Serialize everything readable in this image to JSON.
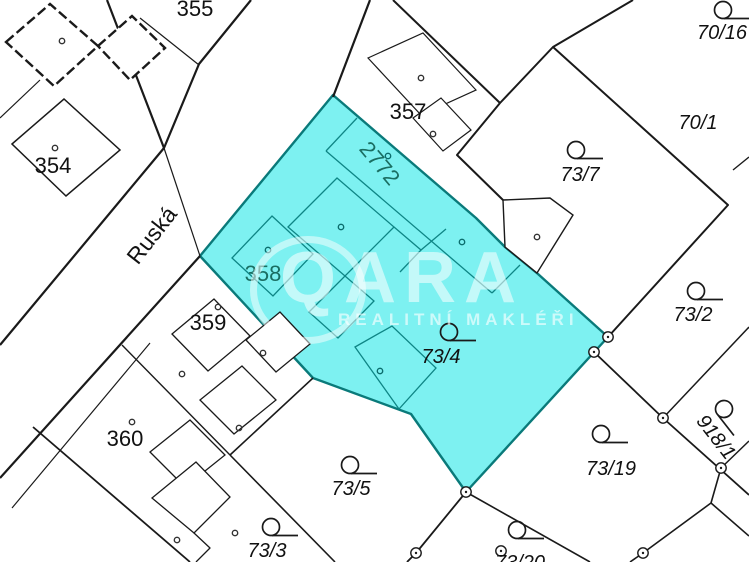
{
  "meta": {
    "width": 749,
    "height": 562
  },
  "watermark": {
    "brand": "QARA",
    "reg": "®",
    "tagline": "REALITNÍ MAKLÉŘI"
  },
  "map": {
    "colors": {
      "background": "#ffffff",
      "line": "#1a1a1a",
      "highlight_fill": "#7DF1F1",
      "highlight_stroke": "#0A7A7A",
      "teal_line": "#0E8585",
      "teal_text": "#1A6E62",
      "label": "#111111"
    },
    "highlight": {
      "outer": [
        [
          333,
          95
        ],
        [
          476,
          218
        ],
        [
          488,
          230
        ],
        [
          505,
          247
        ],
        [
          538,
          274
        ],
        [
          608,
          337
        ],
        [
          466,
          492
        ],
        [
          411,
          414
        ],
        [
          313,
          378
        ],
        [
          200,
          256
        ]
      ],
      "inner_closed": [
        {
          "pts": [
            [
              337,
              178
            ],
            [
              394,
              227
            ],
            [
              345,
              276
            ],
            [
              288,
              227
            ]
          ]
        },
        {
          "pts": [
            [
              272,
              216
            ],
            [
              313,
              254
            ],
            [
              273,
              296
            ],
            [
              232,
              258
            ]
          ]
        },
        {
          "pts": [
            [
              345,
              276
            ],
            [
              374,
              301
            ],
            [
              338,
              338
            ],
            [
              309,
              312
            ]
          ]
        },
        {
          "pts": [
            [
              355,
              347
            ],
            [
              392,
              326
            ],
            [
              436,
              368
            ],
            [
              399,
              409
            ]
          ]
        }
      ],
      "inner_open": [
        {
          "pts": [
            [
              357,
              118
            ],
            [
              326,
              151
            ]
          ]
        },
        {
          "pts": [
            [
              326,
              151
            ],
            [
              492,
              293
            ]
          ]
        },
        {
          "pts": [
            [
              492,
              293
            ],
            [
              520,
              265
            ]
          ]
        },
        {
          "pts": [
            [
              394,
              227
            ],
            [
              421,
              250
            ],
            [
              446,
              229
            ]
          ]
        },
        {
          "pts": [
            [
              421,
              250
            ],
            [
              400,
              272
            ]
          ]
        }
      ],
      "dots": [
        [
          341,
          227
        ],
        [
          268,
          250
        ],
        [
          388,
          156
        ],
        [
          462,
          242
        ],
        [
          380,
          371
        ]
      ]
    },
    "lines": [
      {
        "pts": [
          [
            107,
            0
          ],
          [
            164,
            148
          ]
        ],
        "w": 2.2
      },
      {
        "pts": [
          [
            251,
            0
          ],
          [
            199,
            64
          ],
          [
            164,
            148
          ],
          [
            0,
            345
          ]
        ],
        "w": 2.2
      },
      {
        "pts": [
          [
            370,
            0
          ],
          [
            333,
            97
          ]
        ],
        "w": 2.2
      },
      {
        "pts": [
          [
            200,
            256
          ],
          [
            0,
            478
          ]
        ],
        "w": 2.2
      },
      {
        "pts": [
          [
            140,
            18
          ],
          [
            199,
            65
          ]
        ],
        "w": 1.2
      },
      {
        "pts": [
          [
            0,
            118
          ],
          [
            40,
            80
          ]
        ],
        "w": 1.2
      },
      {
        "pts": [
          [
            164,
            148
          ],
          [
            200,
            256
          ]
        ],
        "w": 1.2
      },
      {
        "pts": [
          [
            393,
            0
          ],
          [
            500,
            103
          ]
        ],
        "w": 2
      },
      {
        "pts": [
          [
            633,
            0
          ],
          [
            553,
            47
          ],
          [
            500,
            103
          ],
          [
            457,
            155
          ],
          [
            503,
            200
          ]
        ],
        "w": 2
      },
      {
        "pts": [
          [
            553,
            47
          ],
          [
            728,
            205
          ],
          [
            608,
            337
          ]
        ],
        "w": 2
      },
      {
        "pts": [
          [
            594,
            352
          ],
          [
            663,
            418
          ],
          [
            749,
            495
          ]
        ],
        "w": 1.8
      },
      {
        "pts": [
          [
            663,
            418
          ],
          [
            749,
            327
          ]
        ],
        "w": 1.5
      },
      {
        "pts": [
          [
            721,
            468
          ],
          [
            749,
            441
          ]
        ],
        "w": 1.5
      },
      {
        "pts": [
          [
            721,
            468
          ],
          [
            711,
            503
          ],
          [
            643,
            553
          ],
          [
            630,
            562
          ]
        ],
        "w": 1.6
      },
      {
        "pts": [
          [
            711,
            503
          ],
          [
            749,
            536
          ]
        ],
        "w": 1.6
      },
      {
        "pts": [
          [
            466,
            492
          ],
          [
            416,
            553
          ],
          [
            407,
            562
          ]
        ],
        "w": 1.8
      },
      {
        "pts": [
          [
            466,
            492
          ],
          [
            590,
            562
          ]
        ],
        "w": 1.6
      },
      {
        "pts": [
          [
            150,
            343
          ],
          [
            12,
            508
          ]
        ],
        "w": 1.2
      },
      {
        "pts": [
          [
            33,
            427
          ],
          [
            190,
            562
          ]
        ],
        "w": 1.8
      },
      {
        "pts": [
          [
            122,
            345
          ],
          [
            230,
            455
          ]
        ],
        "w": 1.4
      },
      {
        "pts": [
          [
            313,
            378
          ],
          [
            230,
            455
          ]
        ],
        "w": 1.6
      },
      {
        "pts": [
          [
            230,
            455
          ],
          [
            335,
            562
          ]
        ],
        "w": 1.6
      },
      {
        "pts": [
          [
            733,
            170
          ],
          [
            749,
            157
          ]
        ],
        "w": 1.4
      },
      {
        "pts": [
          [
            194,
            533
          ],
          [
            210,
            548
          ],
          [
            196,
            562
          ]
        ],
        "w": 1.3
      }
    ],
    "buildings": [
      {
        "pts": [
          [
            503,
            200
          ],
          [
            550,
            198
          ],
          [
            573,
            215
          ],
          [
            537,
            273
          ],
          [
            505,
            247
          ]
        ],
        "w": 1.4
      },
      {
        "pts": [
          [
            368,
            58
          ],
          [
            423,
            33
          ],
          [
            476,
            90
          ],
          [
            421,
            115
          ]
        ],
        "w": 1.2
      },
      {
        "pts": [
          [
            413,
            118
          ],
          [
            441,
            98
          ],
          [
            471,
            130
          ],
          [
            443,
            151
          ]
        ],
        "w": 1.2
      },
      {
        "pts": [
          [
            12,
            144
          ],
          [
            64,
            99
          ],
          [
            120,
            150
          ],
          [
            66,
            196
          ]
        ],
        "w": 1.5
      },
      {
        "pts": [
          [
            6,
            42
          ],
          [
            50,
            4
          ],
          [
            98,
            46
          ],
          [
            54,
            86
          ]
        ],
        "w": 2.4,
        "dash": "10 4"
      },
      {
        "pts": [
          [
            98,
            46
          ],
          [
            132,
            16
          ],
          [
            165,
            48
          ],
          [
            130,
            80
          ]
        ],
        "w": 2.4,
        "dash": "10 4"
      },
      {
        "pts": [
          [
            172,
            334
          ],
          [
            214,
            299
          ],
          [
            250,
            336
          ],
          [
            208,
            371
          ]
        ],
        "w": 1.3
      },
      {
        "pts": [
          [
            246,
            340
          ],
          [
            280,
            312
          ],
          [
            310,
            344
          ],
          [
            276,
            372
          ]
        ],
        "w": 1.3
      },
      {
        "pts": [
          [
            200,
            400
          ],
          [
            242,
            366
          ],
          [
            276,
            400
          ],
          [
            234,
            434
          ]
        ],
        "w": 1.3
      },
      {
        "pts": [
          [
            150,
            452
          ],
          [
            190,
            420
          ],
          [
            225,
            455
          ],
          [
            185,
            487
          ]
        ],
        "w": 1.3
      },
      {
        "pts": [
          [
            152,
            498
          ],
          [
            196,
            462
          ],
          [
            230,
            497
          ],
          [
            194,
            533
          ]
        ],
        "w": 1.3
      }
    ],
    "labels": [
      {
        "text": "355",
        "x": 195,
        "y": 16,
        "s": 22
      },
      {
        "text": "354",
        "x": 53,
        "y": 173,
        "s": 22
      },
      {
        "text": "357",
        "x": 408,
        "y": 119,
        "s": 22
      },
      {
        "text": "359",
        "x": 208,
        "y": 330,
        "s": 22
      },
      {
        "text": "360",
        "x": 125,
        "y": 446,
        "s": 22
      },
      {
        "text": "358",
        "x": 263,
        "y": 281,
        "s": 22,
        "teal": true
      },
      {
        "text": "2772",
        "x": 374,
        "y": 168,
        "s": 22,
        "teal": true,
        "rot": 50
      },
      {
        "text": "Ruská",
        "x": 158,
        "y": 240,
        "s": 23,
        "rot": -52,
        "street": true
      },
      {
        "text": "70/16",
        "x": 722,
        "y": 39,
        "s": 20,
        "i": true
      },
      {
        "text": "70/1",
        "x": 698,
        "y": 129,
        "s": 20,
        "i": true
      },
      {
        "text": "73/7",
        "x": 580,
        "y": 181,
        "s": 20,
        "i": true
      },
      {
        "text": "73/2",
        "x": 693,
        "y": 321,
        "s": 20,
        "i": true
      },
      {
        "text": "73/4",
        "x": 441,
        "y": 363,
        "s": 20,
        "i": true
      },
      {
        "text": "918/1",
        "x": 711,
        "y": 441,
        "s": 20,
        "i": true,
        "rot": 52
      },
      {
        "text": "73/19",
        "x": 611,
        "y": 475,
        "s": 20,
        "i": true
      },
      {
        "text": "73/5",
        "x": 351,
        "y": 495,
        "s": 20,
        "i": true
      },
      {
        "text": "73/3",
        "x": 267,
        "y": 557,
        "s": 20,
        "i": true
      },
      {
        "text": "73/20",
        "x": 520,
        "y": 569,
        "s": 20,
        "i": true
      }
    ],
    "symbols": [
      {
        "x": 723,
        "y": 10
      },
      {
        "x": 576,
        "y": 150
      },
      {
        "x": 696,
        "y": 291
      },
      {
        "x": 449,
        "y": 332
      },
      {
        "x": 601,
        "y": 434
      },
      {
        "x": 350,
        "y": 465
      },
      {
        "x": 271,
        "y": 527
      },
      {
        "x": 517,
        "y": 530
      },
      {
        "x": 724,
        "y": 409,
        "rot": 52
      }
    ],
    "boundary_points": [
      [
        608,
        337
      ],
      [
        594,
        352
      ],
      [
        466,
        492
      ],
      [
        416,
        553
      ],
      [
        663,
        418
      ],
      [
        721,
        468
      ],
      [
        643,
        553
      ],
      [
        501,
        551
      ]
    ],
    "dots": [
      [
        55,
        148
      ],
      [
        62,
        41
      ],
      [
        421,
        78
      ],
      [
        433,
        134
      ],
      [
        537,
        237
      ],
      [
        218,
        307
      ],
      [
        263,
        353
      ],
      [
        182,
        374
      ],
      [
        132,
        422
      ],
      [
        235,
        533
      ],
      [
        239,
        428
      ],
      [
        177,
        540
      ]
    ]
  }
}
